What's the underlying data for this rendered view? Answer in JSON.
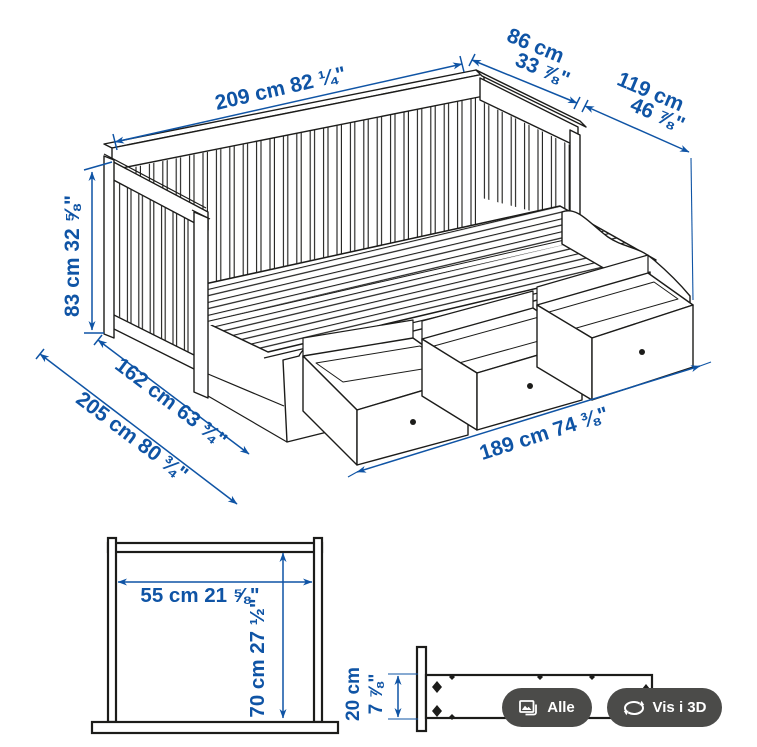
{
  "colors": {
    "dimension_blue": "#0f54a5",
    "drawing_stroke": "#1c1c1a",
    "button_background": "#4b4b49",
    "button_text": "#ffffff"
  },
  "main_diagram": {
    "dim_length_top": "209 cm 82 ¼\"",
    "dim_back_depth_cm": "86 cm",
    "dim_back_depth_in": "33 ⅞\"",
    "dim_total_depth_cm": "119 cm",
    "dim_total_depth_in": "46 ⅞\"",
    "dim_height": "83 cm 32 ⅝\"",
    "dim_bed_width": "162 cm 63 ¾\"",
    "dim_bed_length": "205 cm 80 ¾\"",
    "dim_drawer_span": "189 cm 74 ⅜\""
  },
  "drawer_front_diagram": {
    "dim_width": "55 cm 21 ⅝\"",
    "dim_height": "70 cm 27 ½\""
  },
  "drawer_side_diagram": {
    "dim_height_cm": "20 cm",
    "dim_height_in": "7 ⅞\""
  },
  "toolbar": {
    "all_button_label": "Alle",
    "view_3d_button_label": "Vis i 3D"
  }
}
